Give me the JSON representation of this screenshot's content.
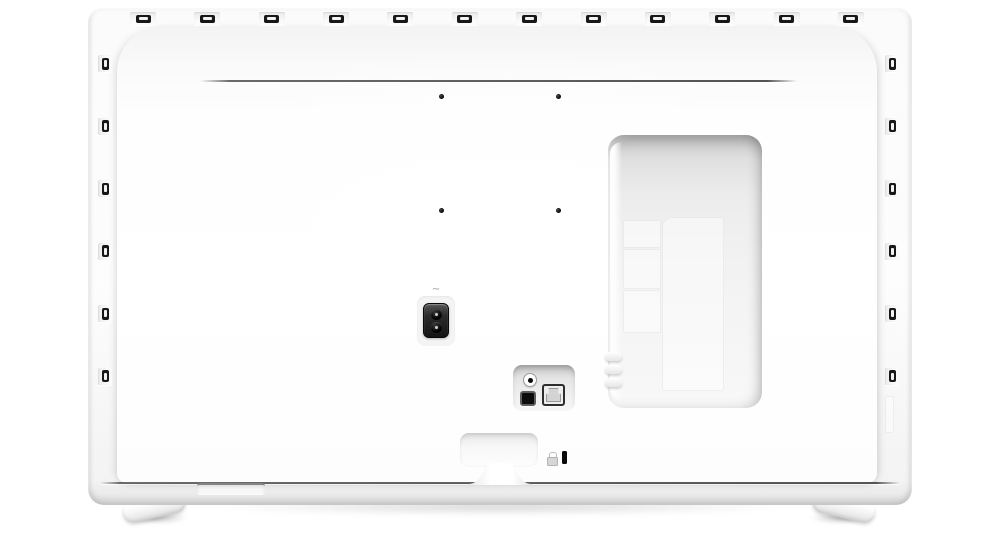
{
  "scene": {
    "description": "Rear view of a white flat-screen television standing on two splayed feet",
    "colors": {
      "background": "#ffffff",
      "chassis_white": "#fdfdfd",
      "panel_seam_gray": "#4a4a4a",
      "vent_slot_black": "#181818",
      "port_black": "#0d0d0d",
      "recess_gray": "#e6e6e6"
    }
  },
  "chassis": {
    "top_vents": 12,
    "left_vents": 6,
    "right_vents": 6
  },
  "mount": {
    "vesa_holes": 4
  },
  "power": {
    "ac_symbol": "∼",
    "pins": 2
  },
  "connection_bay": {
    "floor_panels": 3,
    "side_connectors": 3
  },
  "io_panel": {
    "ports": [
      "audio-jack",
      "optical-audio-port",
      "ethernet-port"
    ]
  },
  "security": {
    "lock_icon": "padlock-icon",
    "slot": "kensington-lock-slot"
  },
  "stand": {
    "feet": 2
  }
}
